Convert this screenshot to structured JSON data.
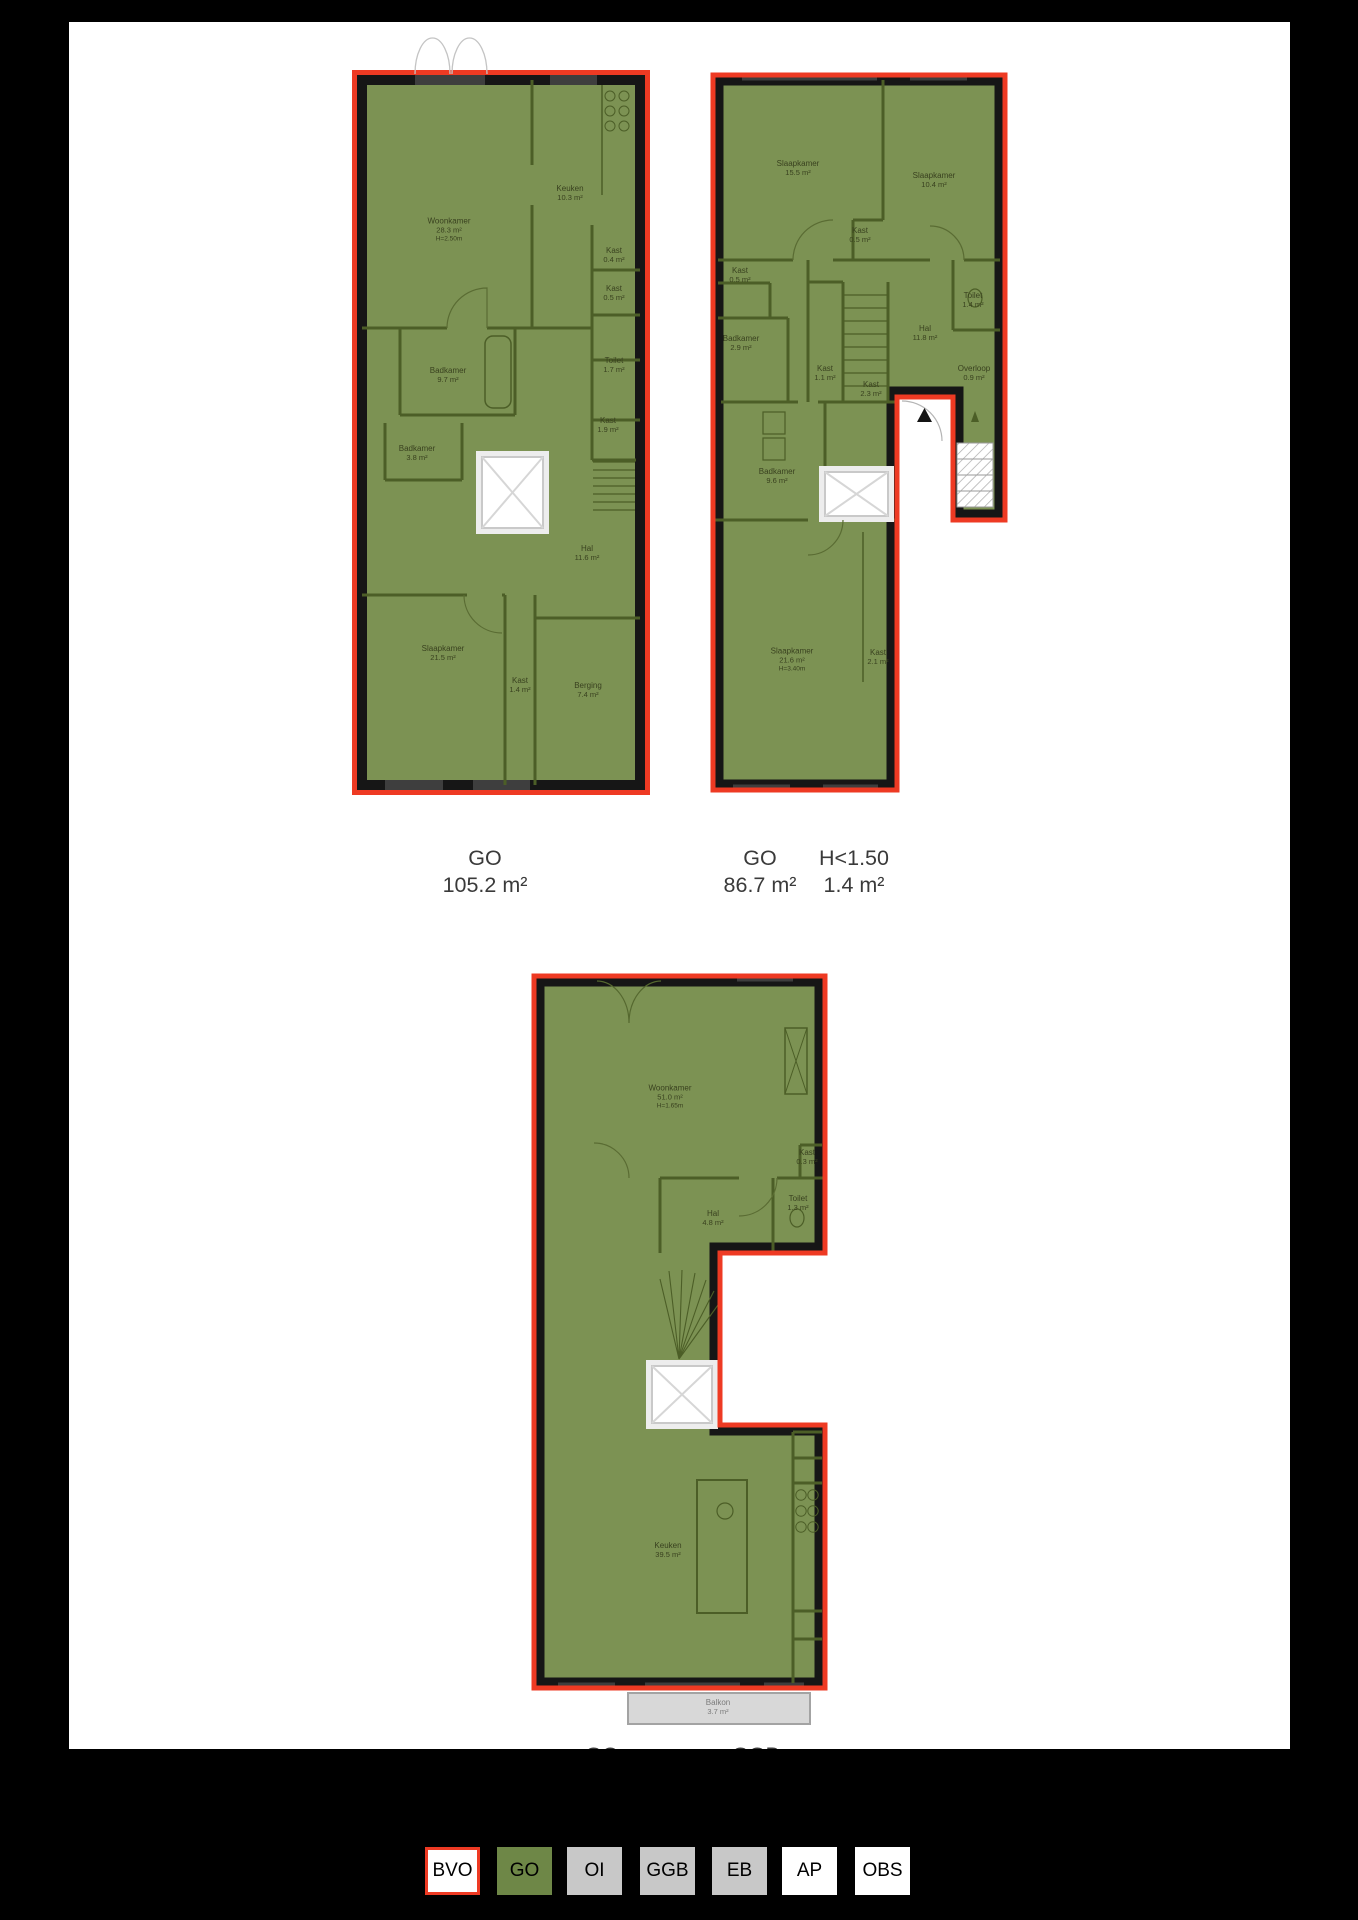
{
  "document": {
    "type": "floorplan-measurement-drawing",
    "page_background": "#ffffff",
    "canvas_background": "#000000"
  },
  "colors": {
    "outline_red": "#ee3a23",
    "go_fill_green": "#7c9253",
    "interior_wall_olive": "#4c5e27",
    "exterior_wall_black": "#161616",
    "window_gray": "#3e3e3e",
    "legend_green": "#6e8747",
    "legend_gray": "#c8c8c8",
    "balcony_gray": "#d8d8d8",
    "label_gray": "#3a3a3a"
  },
  "plans": {
    "floor1": {
      "rooms": [
        {
          "name": "Woonkamer",
          "area": "28.3 m²",
          "note": "H=2.50m",
          "cx": 97,
          "cy": 160
        },
        {
          "name": "Keuken",
          "area": "10.3 m²",
          "cx": 218,
          "cy": 123
        },
        {
          "name": "Kast",
          "area": "0.4 m²",
          "cx": 262,
          "cy": 185
        },
        {
          "name": "Kast",
          "area": "0.5 m²",
          "cx": 262,
          "cy": 223
        },
        {
          "name": "Toilet",
          "area": "1.7 m²",
          "cx": 262,
          "cy": 295
        },
        {
          "name": "Kast",
          "area": "1.9 m²",
          "cx": 256,
          "cy": 355
        },
        {
          "name": "Badkamer",
          "area": "9.7 m²",
          "cx": 96,
          "cy": 305
        },
        {
          "name": "Badkamer",
          "area": "3.8 m²",
          "cx": 65,
          "cy": 383
        },
        {
          "name": "Hal",
          "area": "11.6 m²",
          "cx": 235,
          "cy": 483
        },
        {
          "name": "Slaapkamer",
          "area": "21.5 m²",
          "cx": 91,
          "cy": 583
        },
        {
          "name": "Kast",
          "area": "1.4 m²",
          "cx": 168,
          "cy": 615
        },
        {
          "name": "Berging",
          "area": "7.4 m²",
          "cx": 236,
          "cy": 620
        }
      ]
    },
    "floor2": {
      "rooms": [
        {
          "name": "Slaapkamer",
          "area": "15.5 m²",
          "cx": 90,
          "cy": 98
        },
        {
          "name": "Slaapkamer",
          "area": "10.4 m²",
          "cx": 226,
          "cy": 110
        },
        {
          "name": "Kast",
          "area": "0.5 m²",
          "cx": 152,
          "cy": 165
        },
        {
          "name": "Kast",
          "area": "0.5 m²",
          "cx": 32,
          "cy": 205
        },
        {
          "name": "Badkamer",
          "area": "2.9 m²",
          "cx": 33,
          "cy": 273
        },
        {
          "name": "Toilet",
          "area": "1.4 m²",
          "cx": 265,
          "cy": 230
        },
        {
          "name": "Hal",
          "area": "11.8 m²",
          "cx": 217,
          "cy": 263
        },
        {
          "name": "Kast",
          "area": "1.1 m²",
          "cx": 117,
          "cy": 303
        },
        {
          "name": "Kast",
          "area": "2.3 m²",
          "cx": 163,
          "cy": 319
        },
        {
          "name": "Overloop",
          "area": "0.9 m²",
          "cx": 266,
          "cy": 303
        },
        {
          "name": "Badkamer",
          "area": "9.6 m²",
          "cx": 69,
          "cy": 406
        },
        {
          "name": "Slaapkamer",
          "area": "21.6 m²",
          "note": "H=3.40m",
          "cx": 84,
          "cy": 590
        },
        {
          "name": "Kast",
          "area": "2.1 m²",
          "cx": 170,
          "cy": 587
        }
      ]
    },
    "floor3": {
      "rooms": [
        {
          "name": "Woonkamer",
          "area": "51.0 m²",
          "note": "H=1.65m",
          "cx": 141,
          "cy": 126
        },
        {
          "name": "Kast",
          "area": "0.3 m²",
          "cx": 278,
          "cy": 186
        },
        {
          "name": "Toilet",
          "area": "1.3 m²",
          "cx": 269,
          "cy": 232
        },
        {
          "name": "Hal",
          "area": "4.8 m²",
          "cx": 184,
          "cy": 247
        },
        {
          "name": "Keuken",
          "area": "39.5 m²",
          "cx": 139,
          "cy": 579
        },
        {
          "name": "Balkon",
          "area": "3.7 m²",
          "cx": 189,
          "cy": 736,
          "style": "balcony"
        }
      ]
    }
  },
  "area_labels": {
    "floor1_go": {
      "title": "GO",
      "value": "105.2 m²"
    },
    "floor2_go": {
      "title": "GO",
      "value": "86.7 m²"
    },
    "floor2_h150": {
      "title": "H<1.50",
      "value": "1.4 m²"
    },
    "bottom_cut_left": {
      "title": "GO"
    },
    "bottom_cut_right": {
      "title": "GGB"
    }
  },
  "legend": {
    "items": [
      {
        "label": "BVO",
        "fill": "#ffffff",
        "border": "#ee3a23",
        "x": 425
      },
      {
        "label": "GO",
        "fill": "#6e8747",
        "x": 497
      },
      {
        "label": "OI",
        "fill": "#c8c8c8",
        "x": 567
      },
      {
        "label": "GGB",
        "fill": "#c8c8c8",
        "x": 640
      },
      {
        "label": "EB",
        "fill": "#c8c8c8",
        "x": 712
      },
      {
        "label": "AP",
        "fill": "#ffffff",
        "x": 782
      },
      {
        "label": "OBS",
        "fill": "#ffffff",
        "x": 855
      }
    ]
  }
}
